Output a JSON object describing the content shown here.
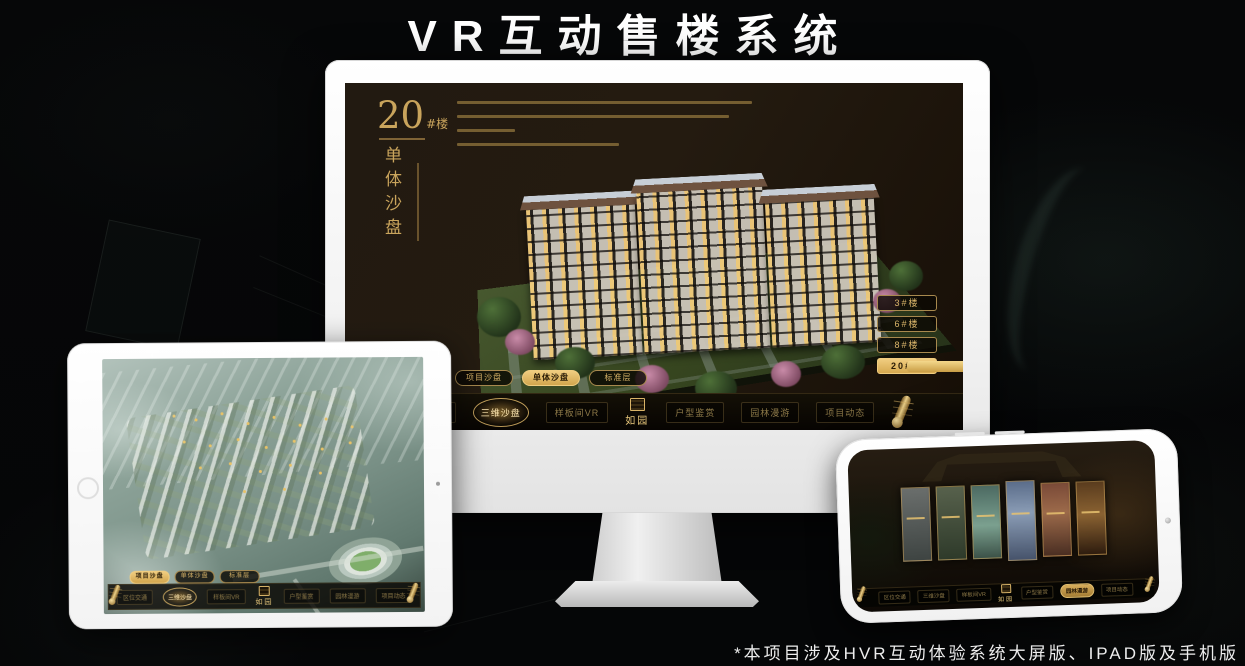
{
  "page": {
    "title": "VR互动售楼系统",
    "footnote": "*本项目涉及HVR互动体验系统大屏版、IPAD版及手机版"
  },
  "colors": {
    "gold": "#D2AC5E",
    "gold_bright": "#EFCF87",
    "screen_background": "#1C140C",
    "device_body": "#F4F4F4"
  },
  "desktop": {
    "heading": {
      "number": "20",
      "suffix": "#楼",
      "vertical": "单体沙盘"
    },
    "floor_buttons": [
      {
        "label": "3#楼",
        "active": false
      },
      {
        "label": "6#楼",
        "active": false
      },
      {
        "label": "8#楼",
        "active": false
      },
      {
        "label": "20#楼",
        "active": true
      }
    ],
    "sub_tabs": [
      {
        "label": "项目沙盘",
        "active": false
      },
      {
        "label": "单体沙盘",
        "active": true
      },
      {
        "label": "标准层",
        "active": false
      }
    ],
    "nav": {
      "left_items": [
        "区位交通",
        "三维沙盘",
        "样板间VR"
      ],
      "right_items": [
        "户型鉴赏",
        "园林漫游",
        "项目动态"
      ],
      "active_item": "三维沙盘",
      "logo": "如园"
    }
  },
  "tablet": {
    "sub_tabs": [
      {
        "label": "项目沙盘",
        "active": true
      },
      {
        "label": "单体沙盘",
        "active": false
      },
      {
        "label": "标准层",
        "active": false
      }
    ],
    "nav": {
      "left_items": [
        "区位交通",
        "三维沙盘",
        "样板间VR"
      ],
      "right_items": [
        "户型鉴赏",
        "园林漫游",
        "项目动态"
      ],
      "active_item": "三维沙盘",
      "logo": "如园"
    }
  },
  "phone": {
    "nav": {
      "left_items": [
        "区位交通",
        "三维沙盘",
        "样板间VR"
      ],
      "right_items": [
        "户型鉴赏",
        "园林漫游",
        "项目动态"
      ],
      "active_item": "园林漫游",
      "logo": "如园"
    }
  }
}
